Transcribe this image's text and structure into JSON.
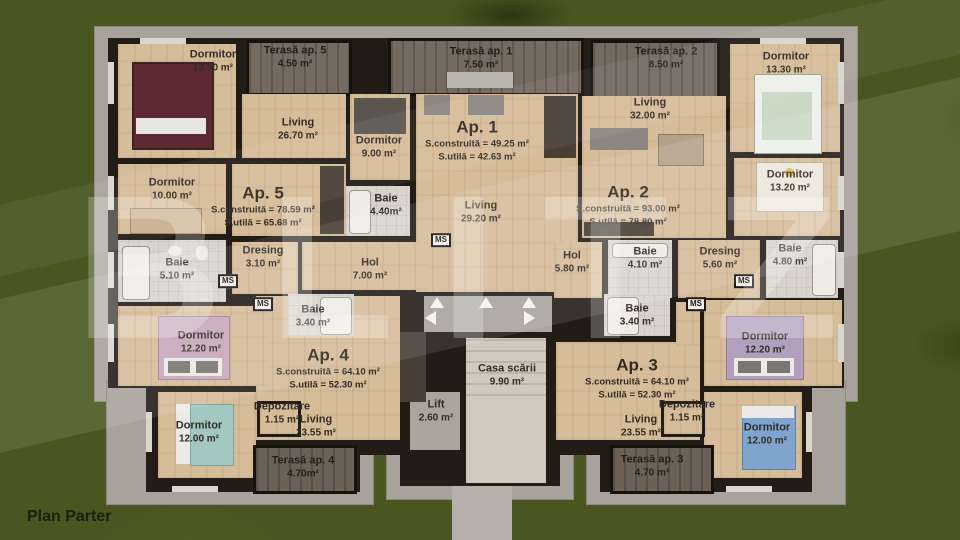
{
  "plan_title": "Plan Parter",
  "watermark": "BLITZ",
  "ms": "MS",
  "apartments": {
    "ap1": {
      "title": "Ap. 1",
      "built": "S.construită = 49.25 m²",
      "usable": "S.utilă = 42.63 m²"
    },
    "ap2": {
      "title": "Ap. 2",
      "built": "S.construită = 93.00 m²",
      "usable": "S.utilă = 78.80 m²"
    },
    "ap3": {
      "title": "Ap. 3",
      "built": "S.construită = 64.10 m²",
      "usable": "S.utilă = 52.30 m²"
    },
    "ap4": {
      "title": "Ap. 4",
      "built": "S.construită = 64.10 m²",
      "usable": "S.utilă = 52.30 m²"
    },
    "ap5": {
      "title": "Ap. 5",
      "built": "S.construită = 78.59 m²",
      "usable": "S.utilă = 65.68 m²"
    }
  },
  "terraces": {
    "t5": {
      "name": "Terasă ap. 5",
      "area": "4.50 m²"
    },
    "t1": {
      "name": "Terasă ap. 1",
      "area": "7.50 m²"
    },
    "t2": {
      "name": "Terasă ap. 2",
      "area": "8.50 m²"
    },
    "t4": {
      "name": "Terasă ap. 4",
      "area": "4.70m²"
    },
    "t3": {
      "name": "Terasă ap. 3",
      "area": "4.70 m²"
    }
  },
  "rooms": {
    "dorm_a5_top": {
      "name": "Dormitor",
      "area": "13.50 m²"
    },
    "living_a5": {
      "name": "Living",
      "area": "26.70 m²"
    },
    "dorm_a5_mid": {
      "name": "Dormitor",
      "area": "10.00 m²"
    },
    "baie_a5": {
      "name": "Baie",
      "area": "5.10 m²"
    },
    "dresing_a5": {
      "name": "Dresing",
      "area": "3.10 m²"
    },
    "dorm_a1": {
      "name": "Dormitor",
      "area": "9.00 m²"
    },
    "baie_a1": {
      "name": "Baie",
      "area": "4.40m²"
    },
    "living_a1": {
      "name": "Living",
      "area": "29.20 m²"
    },
    "living_a2": {
      "name": "Living",
      "area": "32.00 m²"
    },
    "dorm_a2_top": {
      "name": "Dormitor",
      "area": "13.30 m²"
    },
    "dorm_a2_mid": {
      "name": "Dormitor",
      "area": "13.20 m²"
    },
    "hol_a2": {
      "name": "Hol",
      "area": "5.80 m²"
    },
    "baie_a2": {
      "name": "Baie",
      "area": "4.10 m²"
    },
    "dresing_a2": {
      "name": "Dresing",
      "area": "5.60 m²"
    },
    "baie_a2_en": {
      "name": "Baie",
      "area": "4.80 m²"
    },
    "hol_a4": {
      "name": "Hol",
      "area": "7.00 m²"
    },
    "baie_a4": {
      "name": "Baie",
      "area": "3.40 m²"
    },
    "baie_a3": {
      "name": "Baie",
      "area": "3.40 m²"
    },
    "dorm_a4_mid": {
      "name": "Dormitor",
      "area": "12.20 m²"
    },
    "dorm_a3_mid": {
      "name": "Dormitor",
      "area": "12.20 m²"
    },
    "dorm_a4_low": {
      "name": "Dormitor",
      "area": "12.00 m²"
    },
    "dorm_a3_low": {
      "name": "Dormitor",
      "area": "12.00 m²"
    },
    "dep_a4": {
      "name": "Depozitare",
      "area": "1.15 m²"
    },
    "dep_a3": {
      "name": "Depozitare",
      "area": "1.15 m²"
    },
    "living_a4": {
      "name": "Living",
      "area": "23.55 m²"
    },
    "living_a3": {
      "name": "Living",
      "area": "23.55 m²"
    },
    "casa_scarii": {
      "name": "Casa scării",
      "area": "9.90 m²"
    },
    "lift": {
      "name": "Lift",
      "area": "2.60 m²"
    }
  }
}
